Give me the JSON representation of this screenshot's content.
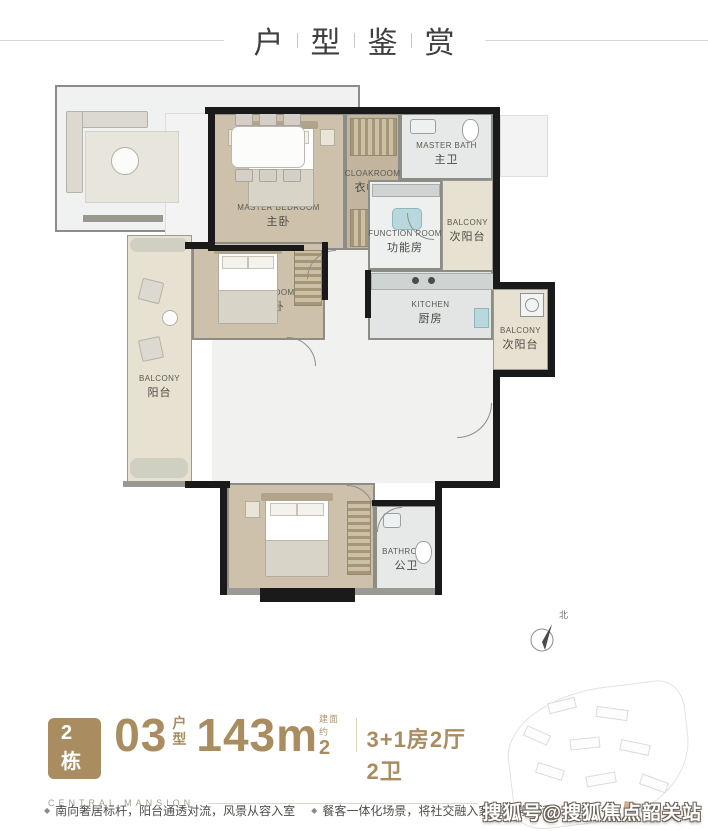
{
  "page": {
    "title_chars": [
      "户",
      "型",
      "鉴",
      "赏"
    ]
  },
  "plan": {
    "compass_label": "北",
    "rooms": {
      "master_bedroom": {
        "en": "MASTER BEDROOM",
        "zh": "主卧"
      },
      "cloakroom": {
        "en": "CLOAKROOM",
        "zh": "衣帽间"
      },
      "master_bath": {
        "en": "MASTER BATH",
        "zh": "主卫"
      },
      "function_room": {
        "en": "FUNCTION ROOM",
        "zh": "功能房"
      },
      "balcony_top": {
        "en": "BALCONY",
        "zh": "次阳台"
      },
      "bedroom_mid": {
        "en": "BEDROOM",
        "zh": "次卧"
      },
      "kitchen": {
        "en": "KITCHEN",
        "zh": "厨房"
      },
      "balcony_right": {
        "en": "BALCONY",
        "zh": "次阳台"
      },
      "balcony_left": {
        "en": "BALCONY",
        "zh": "阳台"
      },
      "living_room": {
        "en": "LIVING ROOM",
        "zh": "客厅"
      },
      "dining_room": {
        "en": "DINING ROOM",
        "zh": "餐厅"
      },
      "bedroom_bottom": {
        "en": "BEDROOM",
        "zh": "次卧"
      },
      "bathroom": {
        "en": "BATHROOM",
        "zh": "公卫"
      }
    }
  },
  "info": {
    "building_badge": "2栋",
    "unit_number": "03",
    "unit_type_label": "户型",
    "area_value": "143m",
    "area_sup": "2",
    "area_note": "建面约",
    "layout_config": "3+1房2厅2卫",
    "brand": "CENTRAL MANSION"
  },
  "features": [
    {
      "bullet": "◆",
      "text": "南向奢居标杆，阳台通透对流，风景从容入室"
    },
    {
      "bullet": "◆",
      "text": "餐客一体化场景，将社交融入家庭日常生活"
    }
  ],
  "watermark": "搜狐号@搜狐焦点韶关站",
  "colors": {
    "accent": "#a98c60",
    "wall": "#1a1a1a",
    "wood_floor": "#cdc1ab",
    "balcony": "#e6e1d0",
    "marble": "#eef0ef"
  }
}
